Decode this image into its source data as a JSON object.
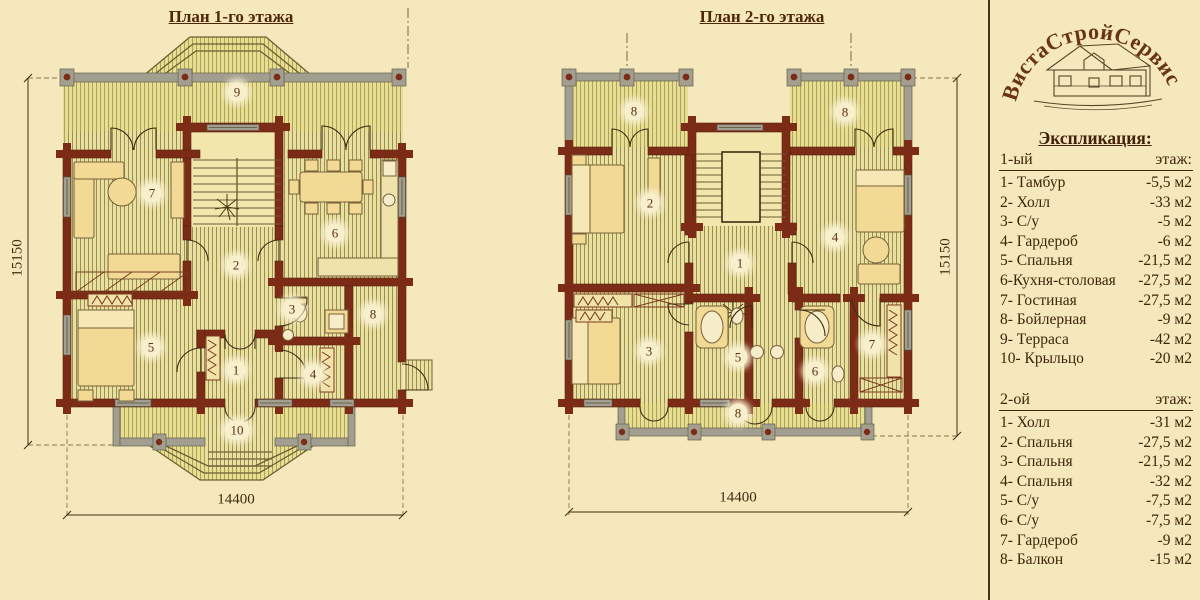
{
  "plans": {
    "floor1": {
      "title": "План 1-го этажа",
      "dims": {
        "width": "14400",
        "height": "15150"
      },
      "rooms": [
        "9",
        "7",
        "2",
        "6",
        "5",
        "1",
        "3",
        "4",
        "8",
        "10"
      ]
    },
    "floor2": {
      "title": "План 2-го этажа",
      "dims": {
        "width": "14400",
        "height": "15150"
      },
      "rooms": [
        "8",
        "8",
        "2",
        "4",
        "1",
        "3",
        "5",
        "6",
        "7",
        "8"
      ]
    }
  },
  "panel": {
    "logo_text": "ВистаСтройСервис",
    "heading": "Экспликация:",
    "floor1": {
      "label": "1-ый",
      "label_right": "этаж:",
      "rows": [
        {
          "name": "1- Тамбур",
          "area": "-5,5 м2"
        },
        {
          "name": "2- Холл",
          "area": "-33 м2"
        },
        {
          "name": "3- С/у",
          "area": "-5 м2"
        },
        {
          "name": "4- Гардероб",
          "area": "-6 м2"
        },
        {
          "name": "5- Спальня",
          "area": "-21,5 м2"
        },
        {
          "name": "6-Кухня-столовая",
          "area": "-27,5 м2"
        },
        {
          "name": "7- Гостиная",
          "area": "-27,5 м2"
        },
        {
          "name": "8- Бойлерная",
          "area": "-9 м2"
        },
        {
          "name": "9- Терраса",
          "area": "-42 м2"
        },
        {
          "name": "10- Крыльцо",
          "area": "-20 м2"
        }
      ]
    },
    "floor2": {
      "label": "2-ой",
      "label_right": "этаж:",
      "rows": [
        {
          "name": "1- Холл",
          "area": "-31 м2"
        },
        {
          "name": "2- Спальня",
          "area": "-27,5 м2"
        },
        {
          "name": "3- Спальня",
          "area": "-21,5 м2"
        },
        {
          "name": "4- Спальня",
          "area": "-32 м2"
        },
        {
          "name": "5- С/у",
          "area": "-7,5 м2"
        },
        {
          "name": "6- С/у",
          "area": "-7,5 м2"
        },
        {
          "name": "7- Гардероб",
          "area": "-9 м2"
        },
        {
          "name": "8- Балкон",
          "area": "-15 м2"
        }
      ]
    }
  },
  "colors": {
    "background": "#f4e8bc",
    "wall": "#7b2b16",
    "gray_wall": "#a29f90",
    "floor_light": "#ebdf9e",
    "floor_stripe": "#968f58",
    "text": "#3f2408"
  }
}
